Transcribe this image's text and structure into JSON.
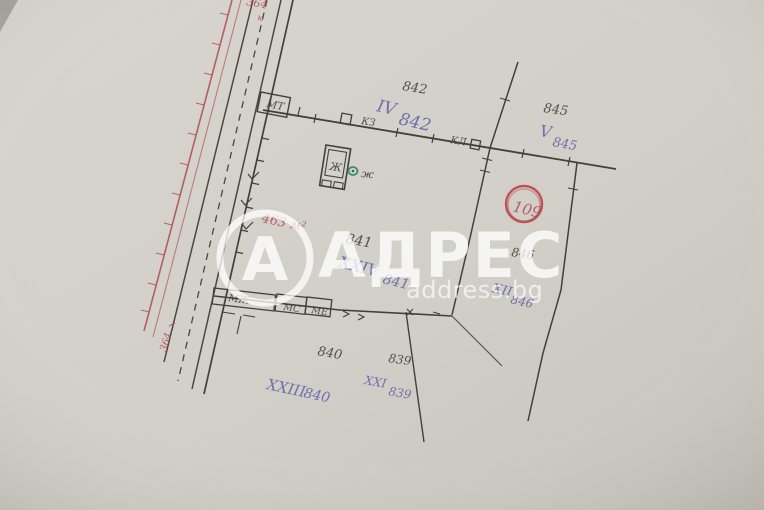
{
  "watermark": {
    "brand": "АДРЕС",
    "site": "address.bg",
    "logo_letter": "А"
  },
  "colors": {
    "paper": "#d3d0c9",
    "ink": "#433f38",
    "red": "#ad4b52",
    "blue": "#5d60a8",
    "green": "#3e8c71",
    "circle_red": "#c05158",
    "watermark_white": "#ffffff"
  },
  "plots": [
    {
      "number": "842",
      "designation_roman": "IV",
      "designation_number": "842"
    },
    {
      "number": "845",
      "designation_roman": "V",
      "designation_number": "845"
    },
    {
      "number": "841",
      "designation_roman": "XXIV",
      "designation_number": "841"
    },
    {
      "number": "846",
      "designation_roman": "XII",
      "designation_number": "846"
    },
    {
      "number": "840",
      "designation_roman": "XXIII",
      "designation_number": "840"
    },
    {
      "number": "839",
      "designation_roman": "XXI",
      "designation_number": "839"
    }
  ],
  "annotations": {
    "circle_number": "109",
    "area_label": "463 м²",
    "road_number_top": "364",
    "road_tick_label": "к",
    "road_number_bottom": "364"
  },
  "survey_labels": {
    "transformer": "МТ",
    "kz": "КЗ",
    "kl": "КЛ",
    "building_mzh": "МЖ",
    "building_ms": "МС",
    "building_me": "МЕ",
    "house_mark": "Ж",
    "well_mark": "ж"
  }
}
